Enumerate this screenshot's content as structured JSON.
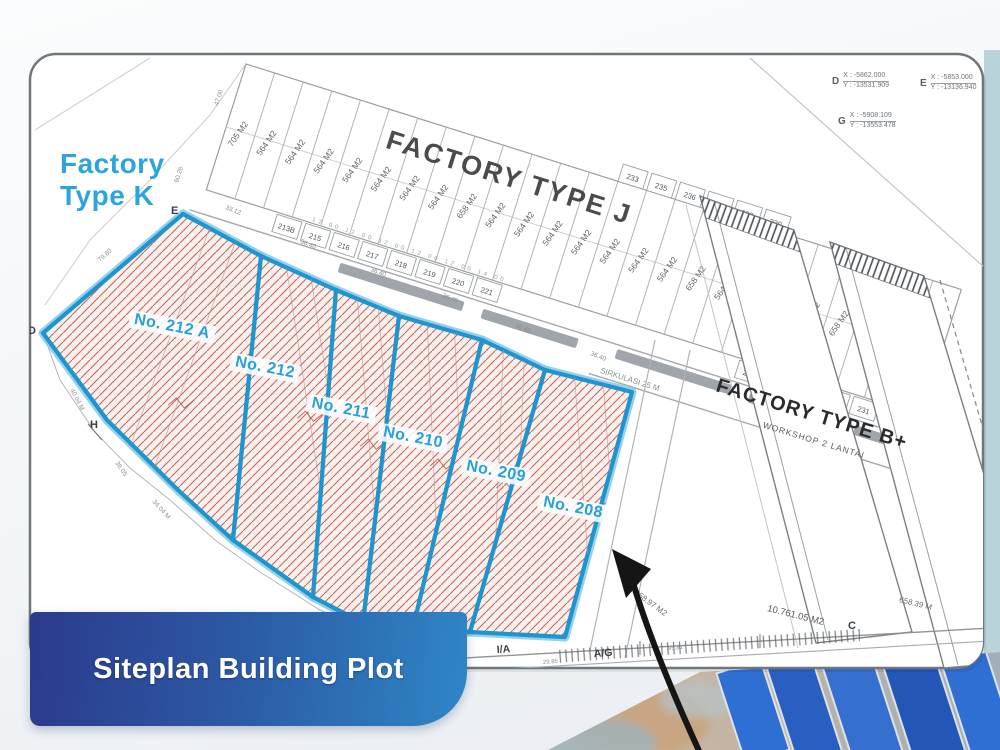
{
  "banner": {
    "title": "Siteplan Building Plot"
  },
  "side_label": {
    "line1": "Factory",
    "line2": "Type K"
  },
  "estate_j": {
    "title": "FACTORY TYPE J",
    "road_label": "SIRKULASI 25 M",
    "road_dims": "12.00  12.00  12.00  12.00  12.00  14.00",
    "strip_labels": [
      "705 M2",
      "564 M2",
      "564 M2",
      "564 M2",
      "564 M2",
      "564 M2",
      "564 M2",
      "564 M2",
      "658 M2",
      "564 M2",
      "564 M2",
      "564 M2",
      "564 M2",
      "564 M2",
      "564 M2",
      "564 M2",
      "658 M2",
      "564 M2",
      "564 M2",
      "564 M2",
      "564 M2",
      "658 M2",
      "658 M2",
      "658 M2",
      "658 M2"
    ],
    "numbers_south": [
      "213B",
      "215",
      "216",
      "217",
      "218",
      "219",
      "220",
      "221"
    ],
    "numbers_south2": [
      "223",
      "225",
      "227",
      "229",
      "231"
    ],
    "numbers_north": [
      "233",
      "235",
      "236",
      "237",
      "238",
      "239"
    ]
  },
  "factory_b": {
    "title": "FACTORY TYPE B+",
    "subtitle": "WORKSHOP 2 LANTAI",
    "area": "10.761.05 M2",
    "area2": "11.058.97 M2",
    "dim_right": "658.39 M"
  },
  "plots": [
    {
      "label": "No. 212 A"
    },
    {
      "label": "No. 212"
    },
    {
      "label": "No. 211"
    },
    {
      "label": "No. 210"
    },
    {
      "label": "No. 209"
    },
    {
      "label": "No. 208"
    }
  ],
  "points": {
    "d": "D",
    "e": "E",
    "h": "H",
    "c": "C",
    "ia": "I/A",
    "ag": "A/G"
  },
  "coords": [
    {
      "pt": "D",
      "x": "X : -5862.000",
      "y": "Y : -13531.909"
    },
    {
      "pt": "E",
      "x": "X : -5853.000",
      "y": "Y : -13136.940"
    },
    {
      "pt": "G",
      "x": "X : -5908.109",
      "y": "Y : -13553.478"
    }
  ],
  "dims": {
    "top_edge": [
      "33.12",
      "36.40",
      "36.40",
      "36.40",
      "36.40",
      "36.40"
    ],
    "left_chain": [
      "79.80",
      "40.04 M",
      "36.05",
      "34.04 M"
    ],
    "bottom": [
      "29.85",
      "95.81"
    ],
    "misc": [
      "47.00",
      "60.26"
    ]
  },
  "colors": {
    "plot_border": "#1d96cf",
    "plot_label": "#25a2d8",
    "hatch": "#c4685c",
    "banner_start": "#2b3a8d",
    "banner_end": "#2e86c6",
    "factory_k_text": "#2ba5dc"
  }
}
